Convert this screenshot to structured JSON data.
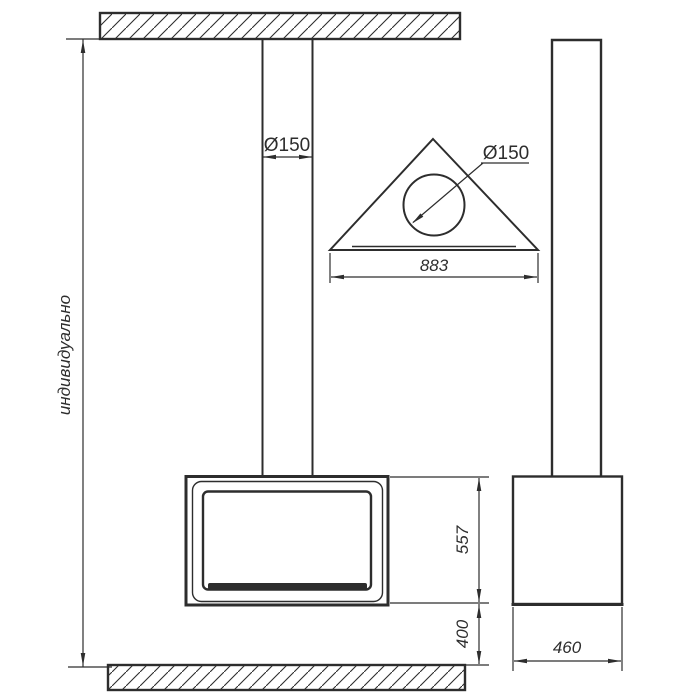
{
  "drawing": {
    "labels": {
      "overall_height": "индивидуально",
      "front_pipe_diameter": "Ø150",
      "top_pipe_diameter": "Ø150",
      "top_plate_width": "883",
      "body_height": "557",
      "floor_clearance": "400",
      "body_depth": "460"
    },
    "colors": {
      "line": "#2d2d2d",
      "background": "#ffffff"
    }
  }
}
